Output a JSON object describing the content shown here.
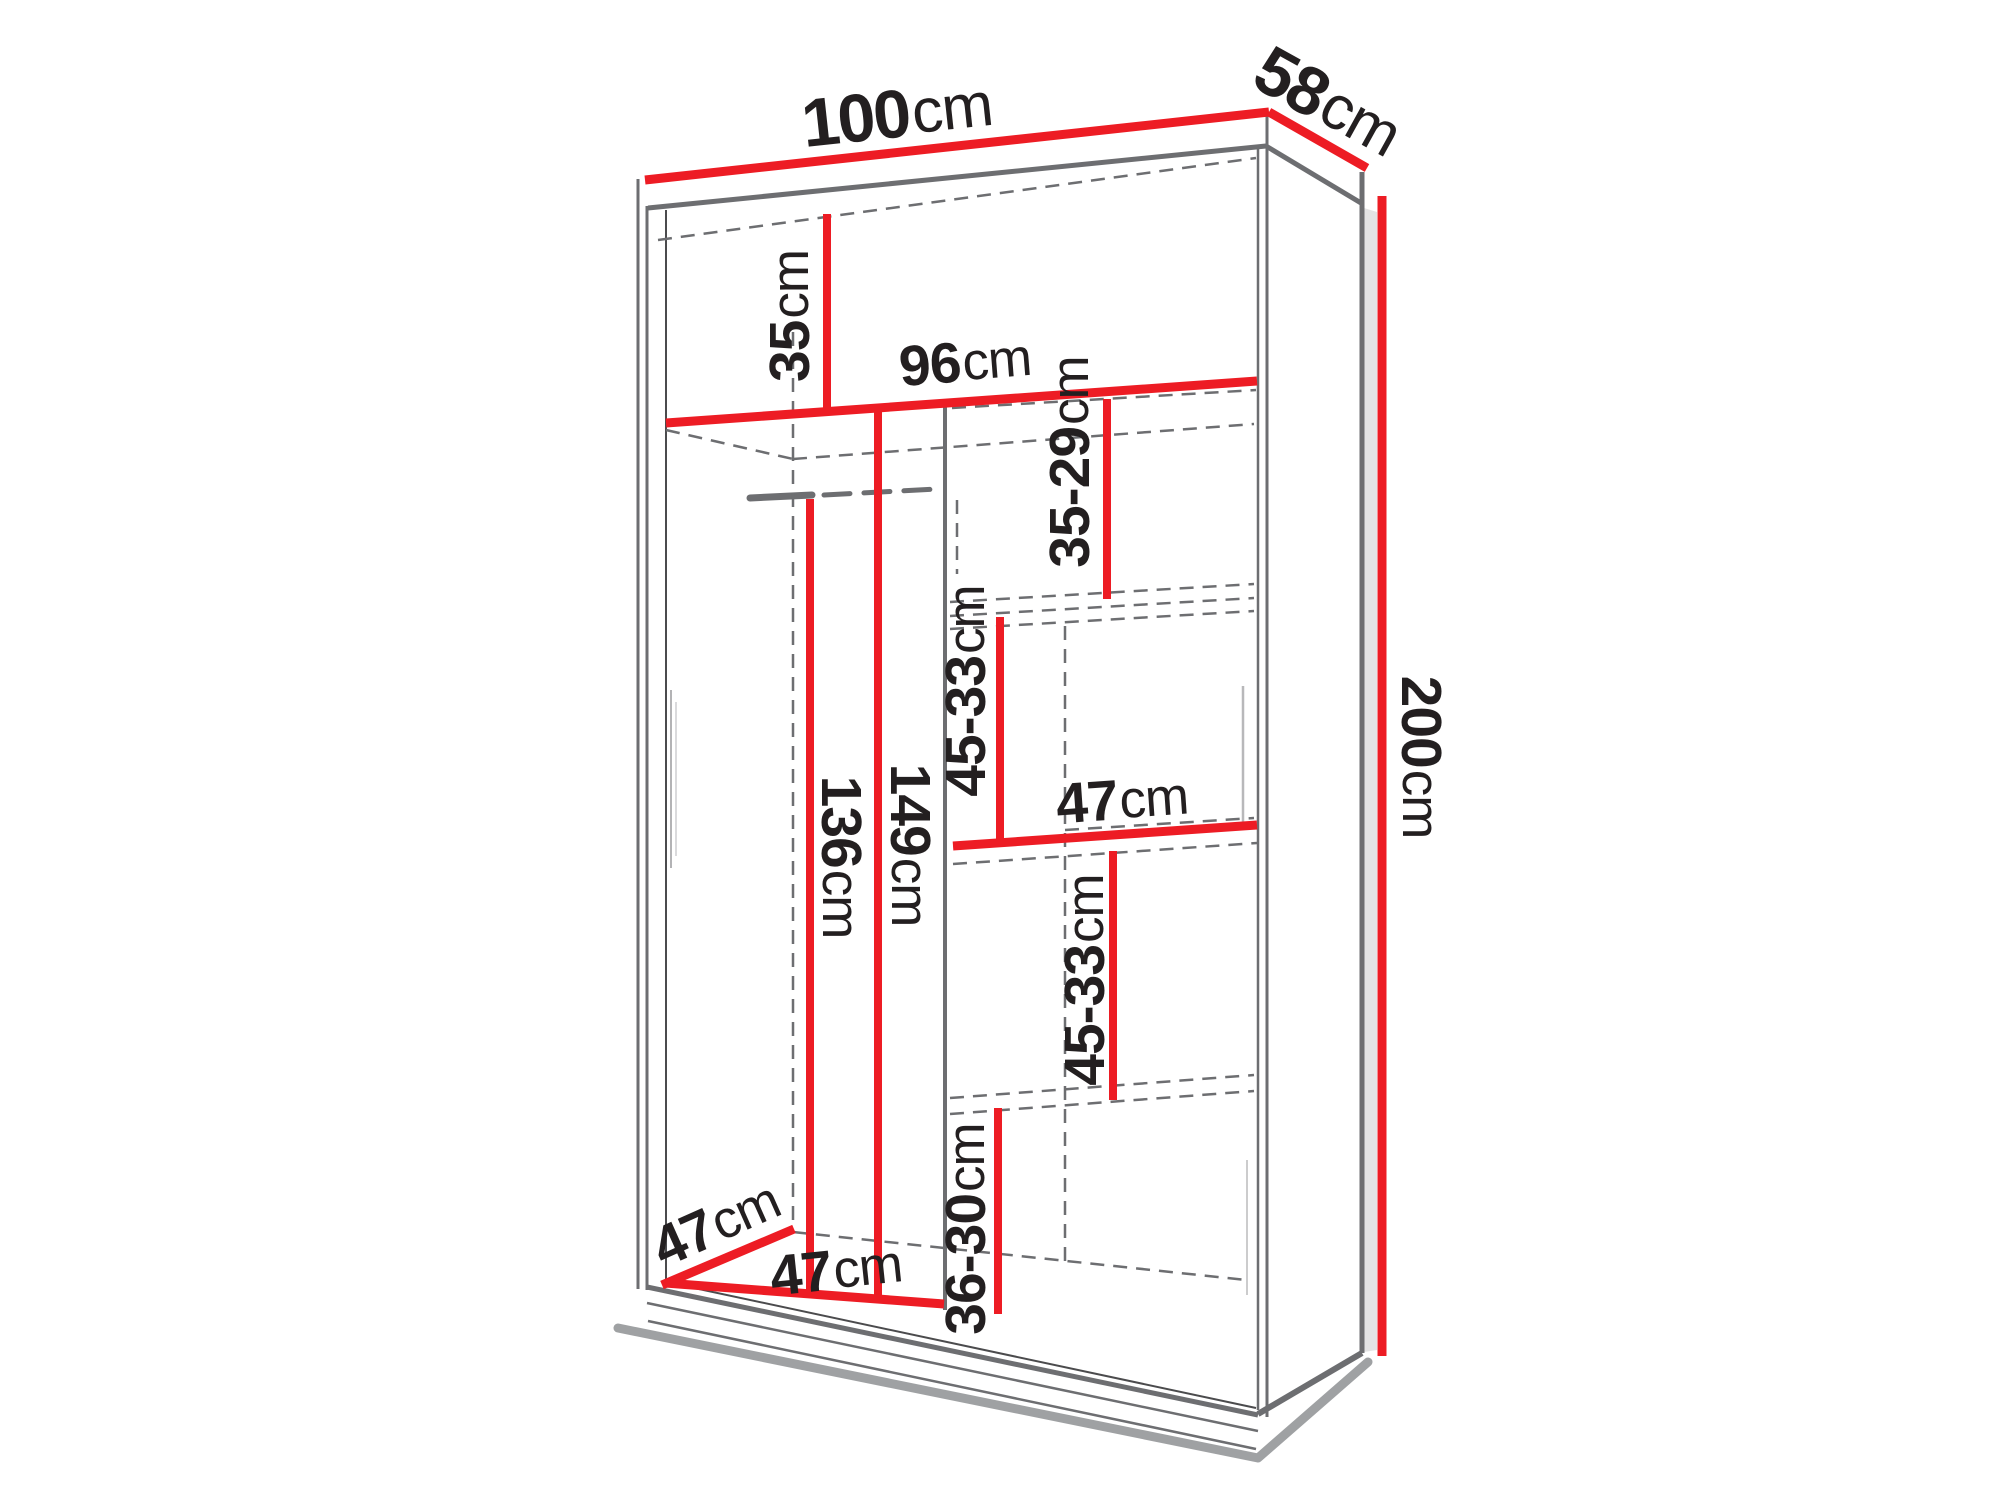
{
  "page": {
    "background": "#ffffff",
    "description": "Wardrobe interior dimension diagram, 3/4 line-drawing view with red dimension lines"
  },
  "colors": {
    "dimension_red": "#ed1c24",
    "outline_gray": "#6d6e71",
    "carcass_dark": "#4b4b4d",
    "dark_ink": "#231f20",
    "side_shade": "#e3e3e4",
    "shadow_gray": "#8e9093"
  },
  "dimensions": {
    "overall_width": {
      "value": "100",
      "unit": "cm"
    },
    "overall_depth": {
      "value": "58",
      "unit": "cm"
    },
    "overall_height": {
      "value": "200",
      "unit": "cm"
    },
    "top_compartment_height": {
      "value": "35",
      "unit": "cm"
    },
    "interior_width": {
      "value": "96",
      "unit": "cm"
    },
    "right_shelf_gap_top": {
      "value": "35-29",
      "unit": "cm"
    },
    "right_shelf_gap_upper": {
      "value": "45-33",
      "unit": "cm"
    },
    "right_shelf_width": {
      "value": "47",
      "unit": "cm"
    },
    "right_shelf_gap_lower": {
      "value": "45-33",
      "unit": "cm"
    },
    "right_shelf_gap_bottom": {
      "value": "36-30",
      "unit": "cm"
    },
    "hanging_space_height": {
      "value": "136",
      "unit": "cm"
    },
    "left_compartment_height": {
      "value": "149",
      "unit": "cm"
    },
    "interior_depth": {
      "value": "47",
      "unit": "cm"
    },
    "left_compartment_width": {
      "value": "47",
      "unit": "cm"
    }
  }
}
